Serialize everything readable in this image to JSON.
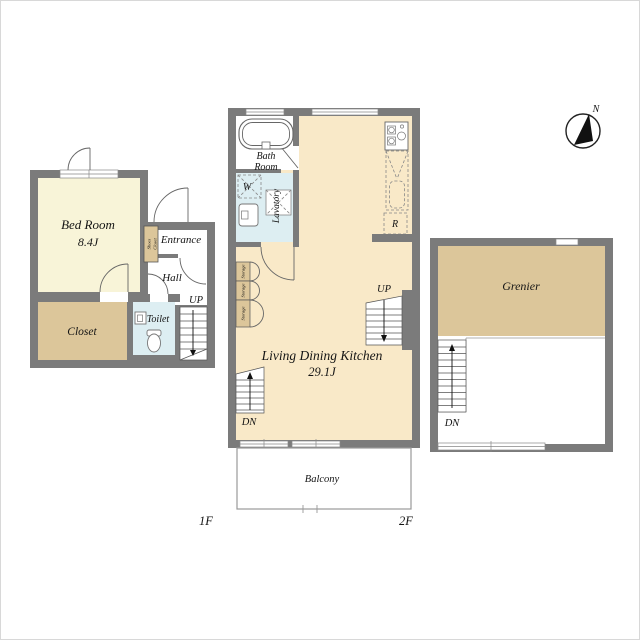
{
  "colors": {
    "wall": "#7b7b7b",
    "bedroom": "#f8f4d8",
    "ldk": "#f9e9c8",
    "tan": "#dcc69a",
    "water": "#ddeef2"
  },
  "compass": {
    "north": "N"
  },
  "floor1": {
    "floor_label": "1F",
    "bedroom_name": "Bed Room",
    "bedroom_size": "8.4J",
    "entrance": "Entrance",
    "hall": "Hall",
    "toilet": "Toilet",
    "closet": "Closet",
    "shoes_closet_line1": "Shoes",
    "shoes_closet_line2": "Closet",
    "stairs_up": "UP"
  },
  "floor2": {
    "floor_label": "2F",
    "bathroom_line1": "Bath",
    "bathroom_line2": "Room",
    "washer": "W",
    "lavatory": "Lavatory",
    "refrigerator": "R",
    "storage": "Storage",
    "ldk_name": "Living Dining Kitchen",
    "ldk_size": "29.1J",
    "stairs_up": "UP",
    "stairs_down": "DN",
    "balcony": "Balcony"
  },
  "attic": {
    "grenier": "Grenier",
    "stairs_down": "DN"
  }
}
